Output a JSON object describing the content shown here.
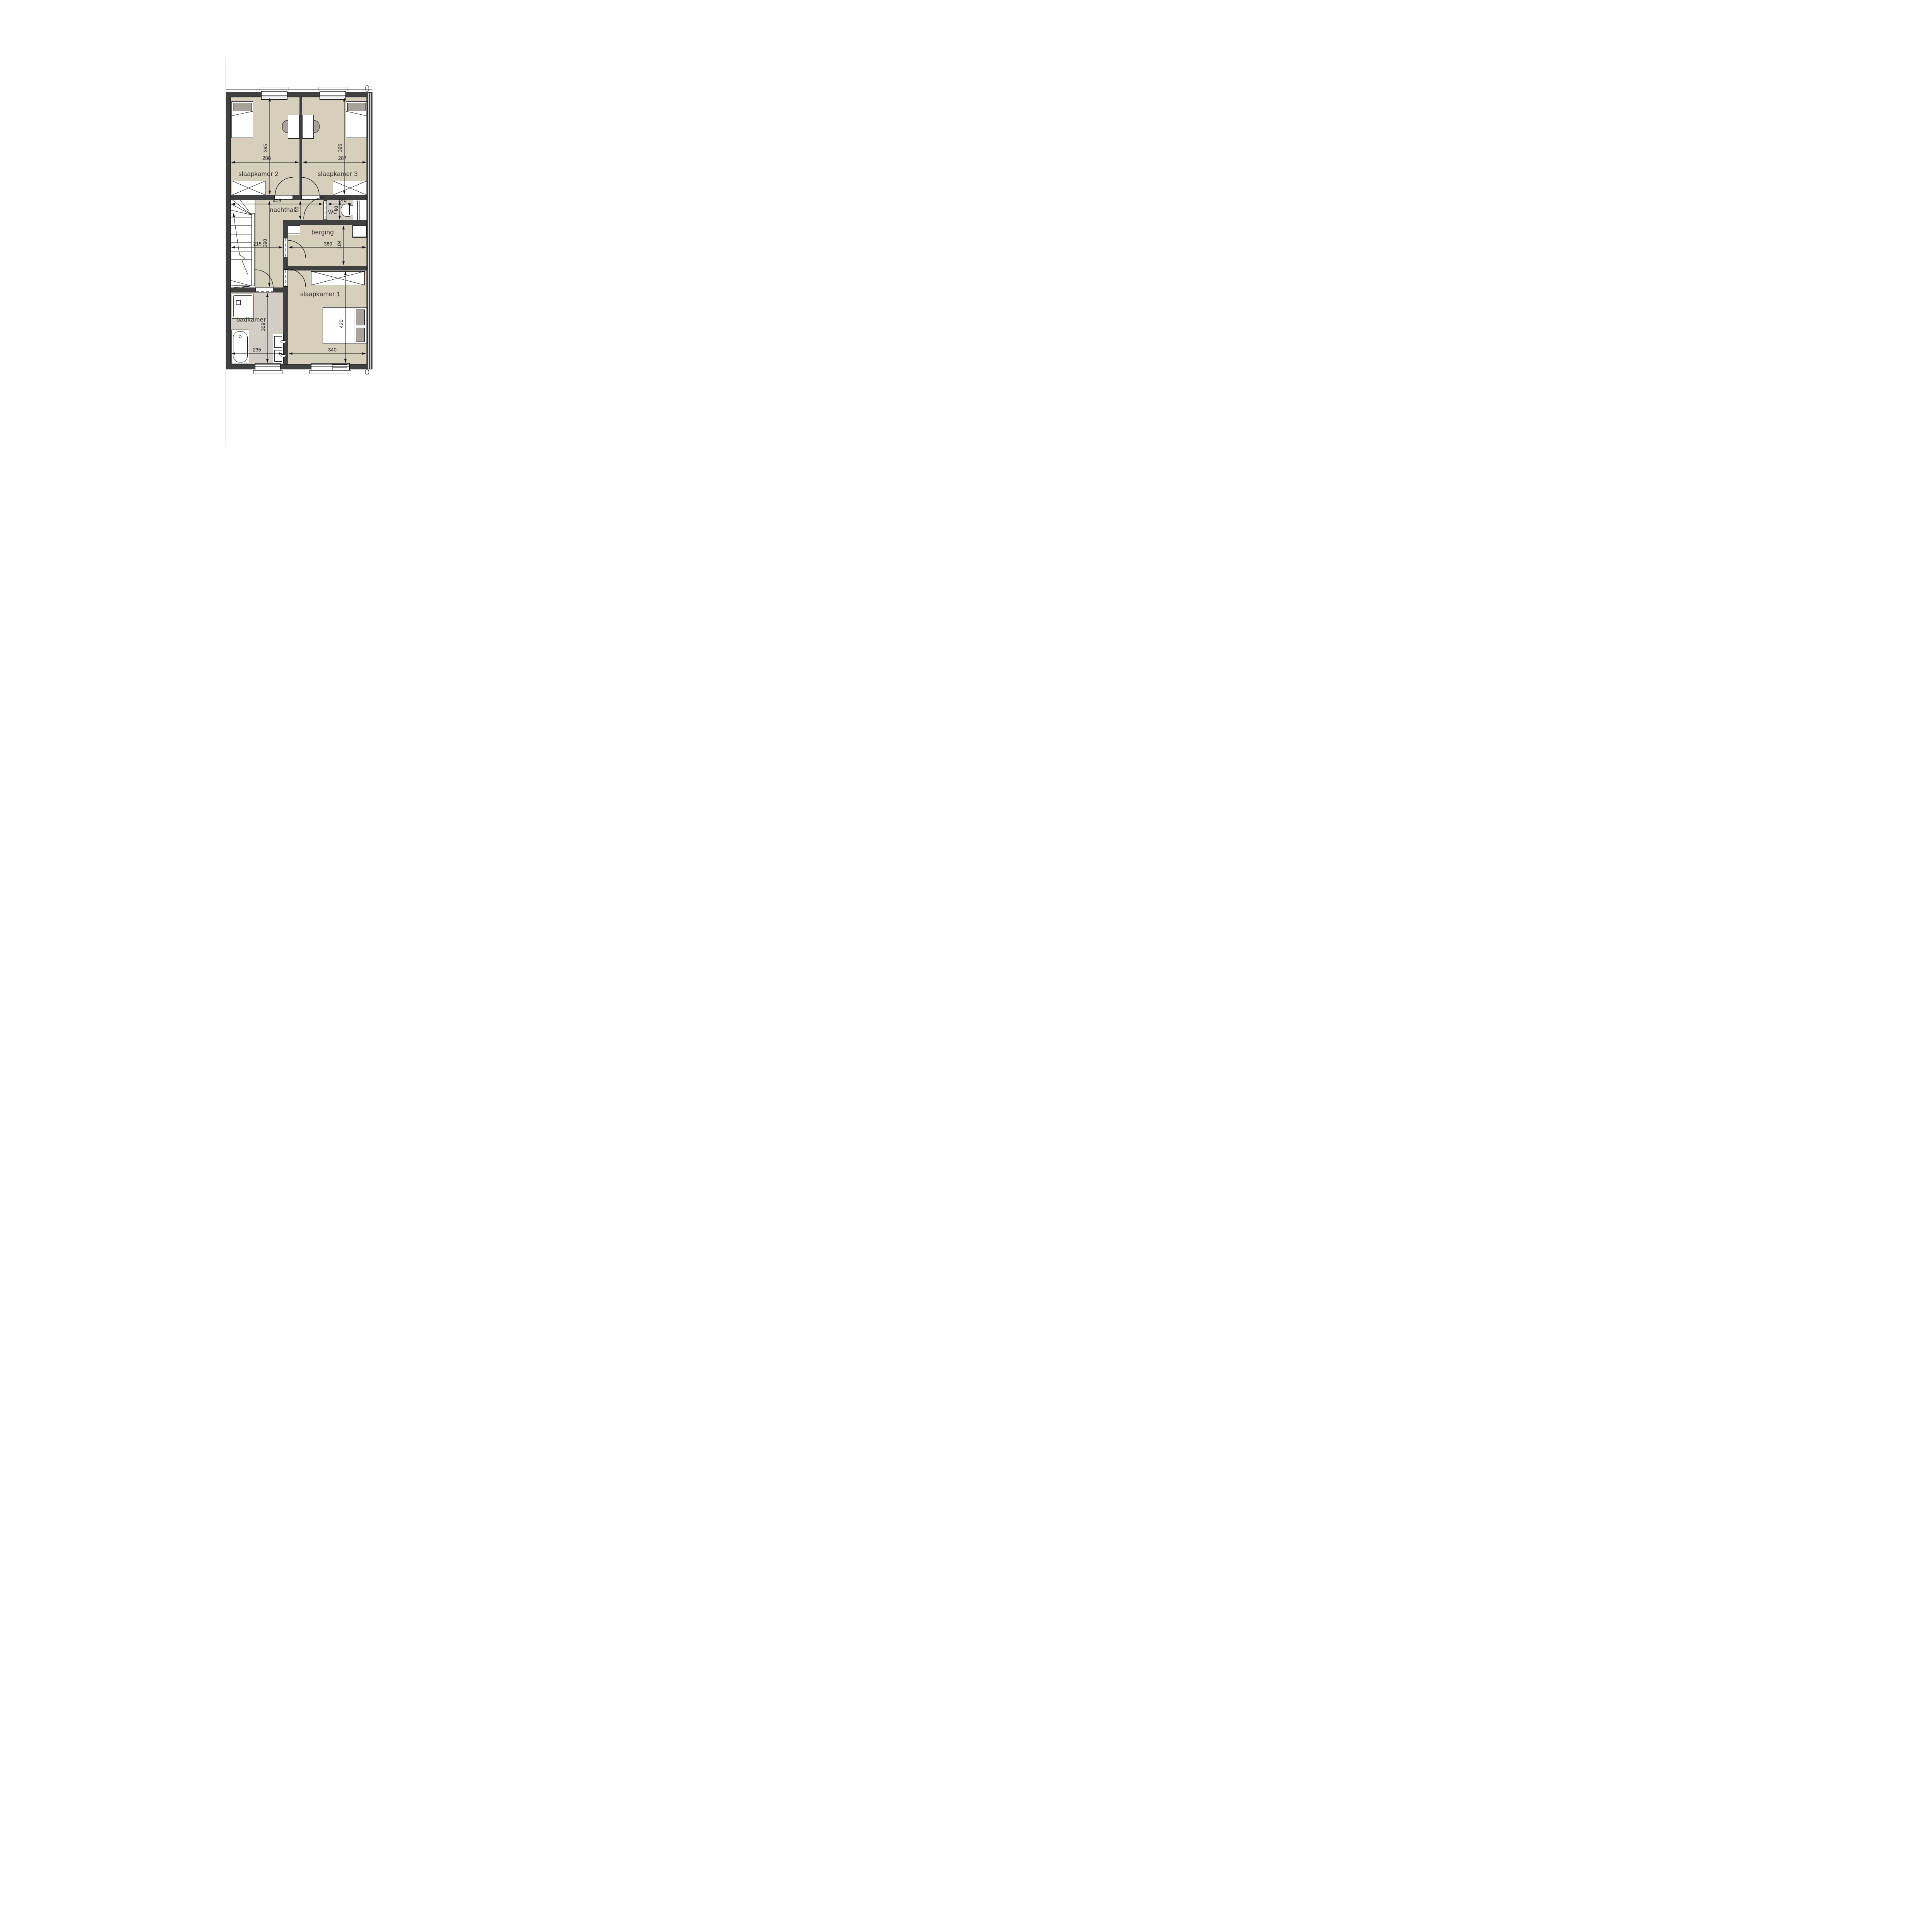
{
  "colors": {
    "wall": "#404040",
    "floor_beige": "#d6cfbc",
    "floor_wet": "#d2cec6",
    "furniture_gray": "#a9a29a"
  },
  "rooms": {
    "slaapkamer2": {
      "label": "slaapkamer 2",
      "width": "288",
      "depth": "395"
    },
    "slaapkamer3": {
      "label": "slaapkamer 3",
      "width": "287",
      "depth": "395"
    },
    "nachthal": {
      "label": "nachthal",
      "length": "405",
      "width": "90",
      "depth": "390",
      "stair_width": "215"
    },
    "wc": {
      "label": "WC",
      "width": "140",
      "depth": "90"
    },
    "berging": {
      "label": "berging",
      "width": "360",
      "depth": "184"
    },
    "slaapkamer1": {
      "label": "slaapkamer 1",
      "width": "340",
      "depth": "420"
    },
    "badkamer": {
      "label": "badkamer",
      "width": "235",
      "depth": "309"
    }
  }
}
